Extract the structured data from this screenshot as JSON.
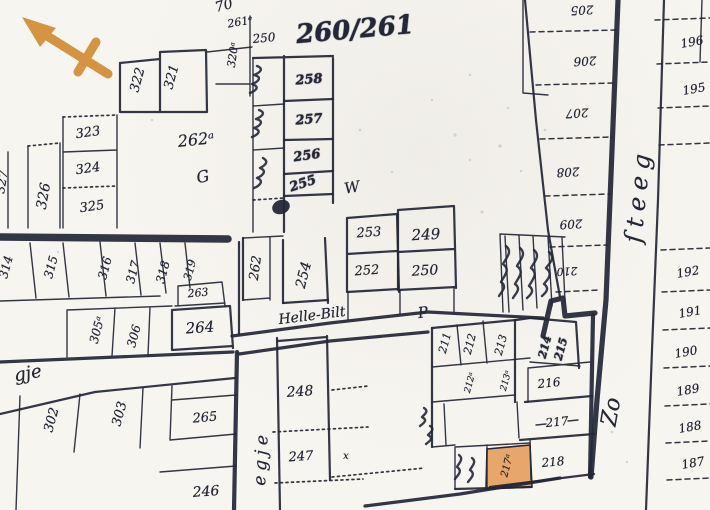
{
  "map": {
    "kind": "historical-cadastral-map",
    "colors": {
      "background": "#f7f5f0",
      "ink": "#242737",
      "arrow": "#d5943f",
      "highlight": "#e7a76a"
    },
    "compass": {
      "name": "north-arrow",
      "direction": "upper-left"
    },
    "highlighted_parcel": {
      "label": "217ᵃ",
      "color": "#e7a76a"
    },
    "labels": [
      {
        "t": "70",
        "x": 224,
        "y": 6,
        "r": -15,
        "s": 14,
        "cls": "script"
      },
      {
        "t": "261ᵉ",
        "x": 240,
        "y": 22,
        "r": -10,
        "s": 11,
        "cls": "script"
      },
      {
        "t": "250",
        "x": 264,
        "y": 38,
        "r": -5,
        "s": 12
      },
      {
        "t": "260/261",
        "x": 355,
        "y": 30,
        "r": -5,
        "s": 26,
        "cls": "script heavy",
        "n": "area-label-260-261"
      },
      {
        "t": "322",
        "x": 138,
        "y": 80,
        "r": -75,
        "s": 13
      },
      {
        "t": "321",
        "x": 172,
        "y": 77,
        "r": -75,
        "s": 13
      },
      {
        "t": "320ᵃ",
        "x": 233,
        "y": 55,
        "r": -82,
        "s": 11
      },
      {
        "t": "323",
        "x": 88,
        "y": 133,
        "r": -8,
        "s": 13
      },
      {
        "t": "324",
        "x": 88,
        "y": 169,
        "r": -8,
        "s": 13
      },
      {
        "t": "325",
        "x": 92,
        "y": 207,
        "r": -8,
        "s": 13
      },
      {
        "t": "326",
        "x": 44,
        "y": 196,
        "r": -80,
        "s": 14
      },
      {
        "t": "327",
        "x": 2,
        "y": 182,
        "r": -80,
        "s": 12
      },
      {
        "t": "262ᵃ",
        "x": 196,
        "y": 140,
        "r": -6,
        "s": 16,
        "cls": "script"
      },
      {
        "t": "G",
        "x": 203,
        "y": 177,
        "r": -12,
        "s": 16,
        "cls": "script"
      },
      {
        "t": "258",
        "x": 309,
        "y": 80,
        "r": -4,
        "s": 13,
        "cls": "heavy"
      },
      {
        "t": "257",
        "x": 309,
        "y": 120,
        "r": -4,
        "s": 13,
        "cls": "heavy"
      },
      {
        "t": "256",
        "x": 307,
        "y": 156,
        "r": -8,
        "s": 13,
        "cls": "heavy"
      },
      {
        "t": "255",
        "x": 303,
        "y": 184,
        "r": -18,
        "s": 13,
        "cls": "heavy"
      },
      {
        "t": "W",
        "x": 352,
        "y": 188,
        "r": -10,
        "s": 15,
        "cls": "script"
      },
      {
        "t": "253",
        "x": 369,
        "y": 233,
        "r": -4,
        "s": 13
      },
      {
        "t": "252",
        "x": 367,
        "y": 271,
        "r": -4,
        "s": 13
      },
      {
        "t": "249",
        "x": 426,
        "y": 235,
        "r": -3,
        "s": 15
      },
      {
        "t": "250",
        "x": 425,
        "y": 271,
        "r": -3,
        "s": 14
      },
      {
        "t": "262",
        "x": 256,
        "y": 268,
        "r": -82,
        "s": 13
      },
      {
        "t": "254",
        "x": 304,
        "y": 275,
        "r": -76,
        "s": 14
      },
      {
        "t": "Helle-Bilt",
        "x": 312,
        "y": 316,
        "r": -7,
        "s": 14,
        "cls": "script",
        "n": "street-label-helle-bilt"
      },
      {
        "t": "P",
        "x": 423,
        "y": 313,
        "r": -8,
        "s": 15,
        "cls": "script"
      },
      {
        "t": "205",
        "x": 582,
        "y": 10,
        "r": 177,
        "s": 12
      },
      {
        "t": "206",
        "x": 585,
        "y": 61,
        "r": 177,
        "s": 12
      },
      {
        "t": "207",
        "x": 577,
        "y": 113,
        "r": 177,
        "s": 12
      },
      {
        "t": "208",
        "x": 568,
        "y": 172,
        "r": 177,
        "s": 12
      },
      {
        "t": "209",
        "x": 571,
        "y": 224,
        "r": 177,
        "s": 12
      },
      {
        "t": "210",
        "x": 567,
        "y": 271,
        "r": 177,
        "s": 11
      },
      {
        "t": "196",
        "x": 692,
        "y": 42,
        "r": -10,
        "s": 12
      },
      {
        "t": "195",
        "x": 694,
        "y": 89,
        "r": -10,
        "s": 12
      },
      {
        "t": "192",
        "x": 688,
        "y": 272,
        "r": -10,
        "s": 12
      },
      {
        "t": "191",
        "x": 690,
        "y": 312,
        "r": -10,
        "s": 12
      },
      {
        "t": "190",
        "x": 686,
        "y": 352,
        "r": -10,
        "s": 12
      },
      {
        "t": "189",
        "x": 688,
        "y": 390,
        "r": -10,
        "s": 12
      },
      {
        "t": "188",
        "x": 690,
        "y": 427,
        "r": -10,
        "s": 12
      },
      {
        "t": "187",
        "x": 693,
        "y": 463,
        "r": -10,
        "s": 12
      },
      {
        "t": "ſteeg",
        "x": 638,
        "y": 195,
        "r": -84,
        "s": 24,
        "cls": "script wide",
        "n": "street-label-steeg"
      },
      {
        "t": "Zo",
        "x": 612,
        "y": 412,
        "r": -80,
        "s": 22,
        "cls": "script",
        "n": "street-label-zo"
      },
      {
        "t": "gje",
        "x": 28,
        "y": 374,
        "r": -10,
        "s": 18,
        "cls": "script",
        "n": "street-label-gje"
      },
      {
        "t": "egje",
        "x": 262,
        "y": 458,
        "r": -87,
        "s": 17,
        "cls": "script wide",
        "n": "street-label-egje"
      },
      {
        "t": "314",
        "x": 6,
        "y": 267,
        "r": -75,
        "s": 12
      },
      {
        "t": "315",
        "x": 51,
        "y": 267,
        "r": -75,
        "s": 12
      },
      {
        "t": "316",
        "x": 105,
        "y": 268,
        "r": -75,
        "s": 12
      },
      {
        "t": "317",
        "x": 133,
        "y": 272,
        "r": -75,
        "s": 12
      },
      {
        "t": "318",
        "x": 163,
        "y": 272,
        "r": -75,
        "s": 12
      },
      {
        "t": "319",
        "x": 190,
        "y": 270,
        "r": -75,
        "s": 11
      },
      {
        "t": "263",
        "x": 198,
        "y": 293,
        "r": -5,
        "s": 11
      },
      {
        "t": "264",
        "x": 200,
        "y": 328,
        "r": -4,
        "s": 15
      },
      {
        "t": "305ᵃ",
        "x": 97,
        "y": 330,
        "r": -75,
        "s": 12
      },
      {
        "t": "306",
        "x": 134,
        "y": 336,
        "r": -75,
        "s": 12
      },
      {
        "t": "302",
        "x": 52,
        "y": 420,
        "r": -75,
        "s": 13
      },
      {
        "t": "303",
        "x": 120,
        "y": 414,
        "r": -75,
        "s": 13
      },
      {
        "t": "265",
        "x": 205,
        "y": 418,
        "r": -5,
        "s": 13
      },
      {
        "t": "246",
        "x": 206,
        "y": 492,
        "r": -4,
        "s": 14
      },
      {
        "t": "248",
        "x": 300,
        "y": 392,
        "r": -4,
        "s": 14
      },
      {
        "t": "247",
        "x": 301,
        "y": 457,
        "r": -4,
        "s": 13
      },
      {
        "t": "x",
        "x": 346,
        "y": 457,
        "r": 0,
        "s": 10,
        "n": "cross-mark"
      },
      {
        "t": "211",
        "x": 445,
        "y": 343,
        "r": -75,
        "s": 11
      },
      {
        "t": "212",
        "x": 470,
        "y": 344,
        "r": -75,
        "s": 11
      },
      {
        "t": "213",
        "x": 501,
        "y": 345,
        "r": -75,
        "s": 11
      },
      {
        "t": "214",
        "x": 545,
        "y": 347,
        "r": -75,
        "s": 11,
        "cls": "heavy"
      },
      {
        "t": "215",
        "x": 561,
        "y": 349,
        "r": -75,
        "s": 11,
        "cls": "heavy"
      },
      {
        "t": "212ᵃ",
        "x": 471,
        "y": 383,
        "r": -75,
        "s": 9
      },
      {
        "t": "213ᵃ",
        "x": 507,
        "y": 381,
        "r": -75,
        "s": 9
      },
      {
        "t": "216",
        "x": 549,
        "y": 383,
        "r": -6,
        "s": 12
      },
      {
        "t": "217",
        "x": 557,
        "y": 422,
        "r": -6,
        "s": 12
      },
      {
        "t": "218",
        "x": 553,
        "y": 462,
        "r": -5,
        "s": 12
      },
      {
        "t": "217ᵃ",
        "x": 508,
        "y": 466,
        "r": -76,
        "s": 10,
        "n": "highlight-parcel-label"
      }
    ]
  }
}
